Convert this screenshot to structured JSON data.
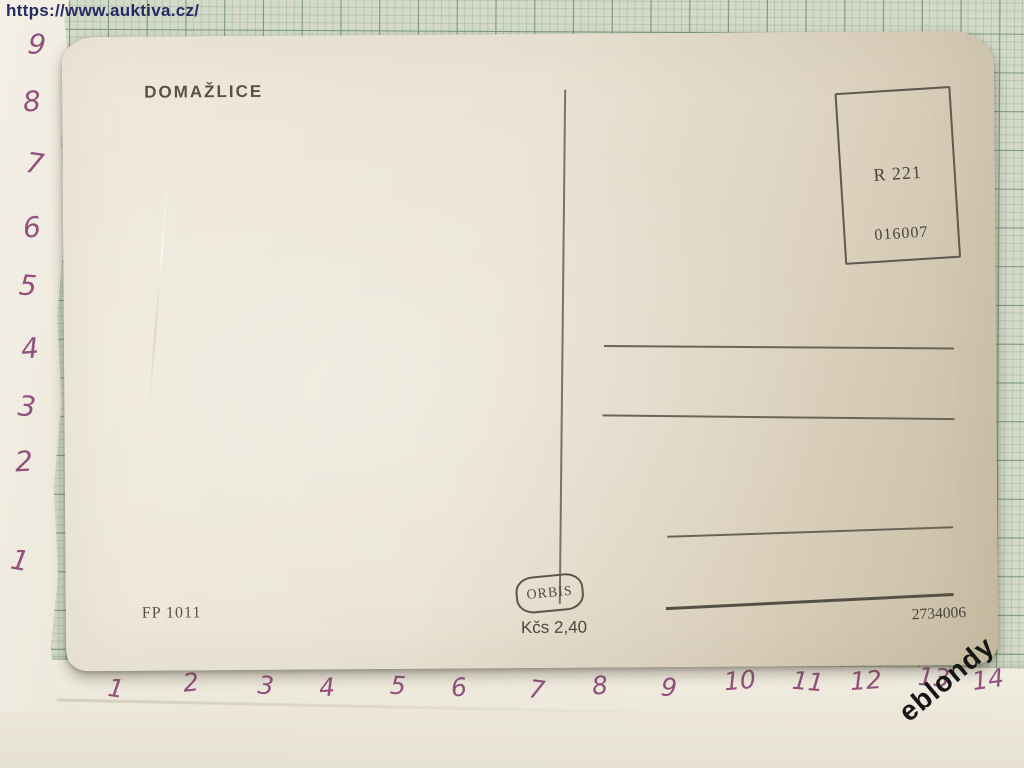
{
  "source_url": "https://www.auktiva.cz/",
  "watermark": "eblondy",
  "postcard": {
    "title": "DOMAŽLICE",
    "registration_label": "R 221",
    "control_number": "016007",
    "order_code": "FP 1011",
    "publisher": "ORBIS",
    "price": "Kčs 2,40",
    "print_number": "2734006"
  },
  "ruler": {
    "vertical_numbers": [
      "9",
      "8",
      "7",
      "6",
      "5",
      "4",
      "3",
      "2",
      "1"
    ],
    "horizontal_numbers": [
      "1",
      "2",
      "3",
      "4",
      "5",
      "6",
      "7",
      "8",
      "9",
      "10",
      "11",
      "12",
      "13",
      "14"
    ]
  },
  "colors": {
    "graph_paper": "#d3dac9",
    "grid_minor": "#b2c1a9",
    "grid_major": "#6f8f75",
    "postcard_cream": "#e9e3d4",
    "postcard_tan_shadow": "#c8bca3",
    "ink": "#575148",
    "handwriting_purple": "#92517d",
    "url_blue": "#262b63",
    "watermark_black": "#161616"
  }
}
